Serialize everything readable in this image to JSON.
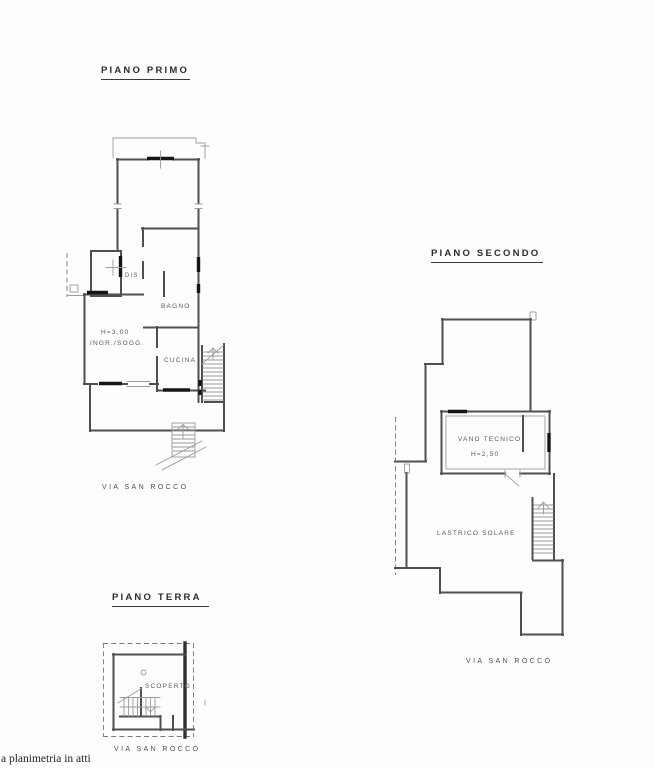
{
  "document": {
    "type": "floor-plan-scan",
    "note": "a planimetria in atti"
  },
  "colors": {
    "background": "#fdfdfc",
    "wall": "#4f4f4f",
    "thin_line": "#9b9b9b",
    "window_bar": "#151515",
    "text": "#5a5a5a"
  },
  "plans": {
    "piano_primo": {
      "title": "PIANO PRIMO",
      "street": "VIA SAN ROCCO",
      "rooms": {
        "dis": "DIS",
        "bagno": "BAGNO",
        "height": "H=3,00",
        "ingresso_soggiorno": "INGR./SOGG.",
        "cucina": "CUCINA"
      }
    },
    "piano_secondo": {
      "title": "PIANO SECONDO",
      "street": "VIA SAN ROCCO",
      "rooms": {
        "vano_tecnico": "VANO TECNICO",
        "height": "H=2,50",
        "lastrico_solare": "LASTRICO SOLARE"
      }
    },
    "piano_terra": {
      "title": "PIANO TERRA",
      "street": "VIA SAN ROCCO",
      "rooms": {
        "scoperto": "SCOPERTO"
      }
    }
  }
}
